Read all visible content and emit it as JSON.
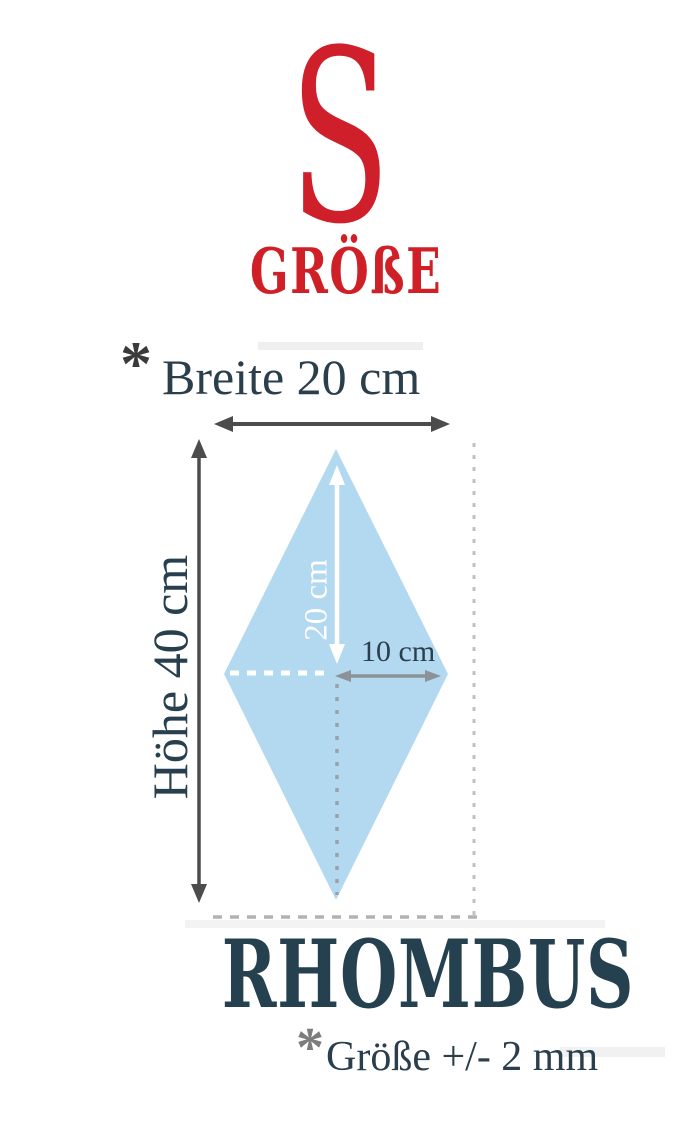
{
  "product_size": {
    "letter": "S",
    "label": "GRÖßE"
  },
  "diagram": {
    "width_note_marker": "*",
    "width_label": "Breite 20 cm",
    "height_label": "Höhe 40 cm",
    "half_height_label": "20 cm",
    "half_width_label": "10 cm"
  },
  "shape": {
    "title": "RHOMBUS",
    "tolerance_marker": "*",
    "tolerance_note": "Größe +/- 2 mm"
  },
  "dimensions": {
    "width_cm": 20,
    "height_cm": 40,
    "half_width_cm": 10,
    "half_height_cm": 20,
    "tolerance_mm": 2
  },
  "colors": {
    "brand_red": "#ce1f2b",
    "text_dark_slate": "#2a3e4c",
    "title_dark_slate": "#25404e",
    "rhombus_fill": "#b3d9f1",
    "arrow_dark": "#4c4c4c",
    "arrow_mid_gray": "#8d9298",
    "dash_gray": "#9aa1a7",
    "dash_light_gray": "#bfc2c4"
  }
}
